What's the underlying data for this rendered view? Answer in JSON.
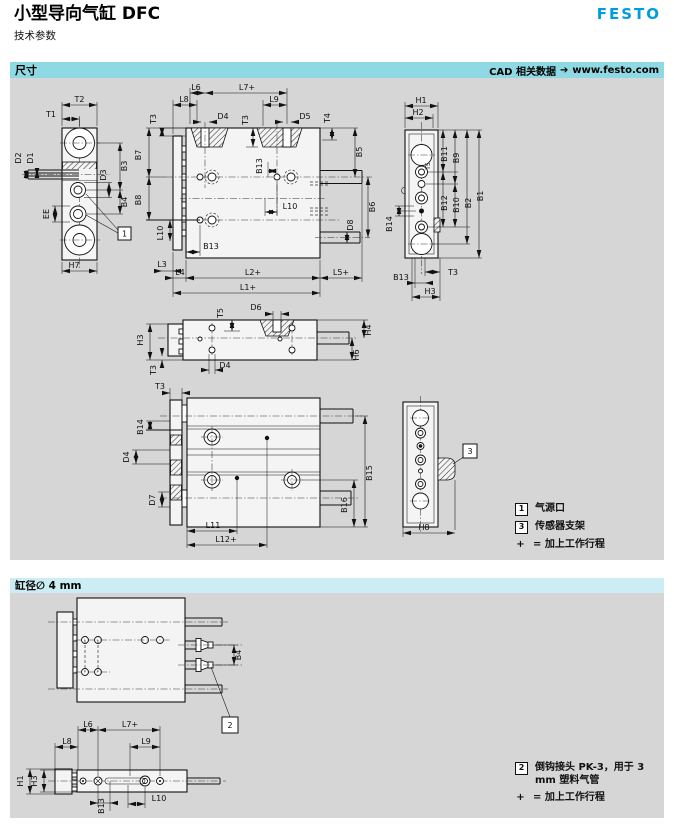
{
  "page": {
    "title": "小型导向气缸 DFC",
    "subtitle": "技术参数",
    "brand": "FESTO"
  },
  "sections": {
    "dimensions": {
      "label": "尺寸",
      "cad_text": "CAD 相关数据",
      "arrow": "➔",
      "cad_url": "www.festo.com"
    },
    "bore": {
      "label": "缸径∅ 4 mm"
    }
  },
  "legends": {
    "dimensions": {
      "items": [
        {
          "ref": "1",
          "text": "气源口"
        },
        {
          "ref": "3",
          "text": "传感器支架"
        }
      ],
      "plus": "+",
      "plus_text": "= 加上工作行程"
    },
    "bore": {
      "items": [
        {
          "ref": "2",
          "text": "倒钩接头 PK-3，用于 3 mm 塑料气管"
        }
      ],
      "plus": "+",
      "plus_text": "= 加上工作行程"
    }
  },
  "colors": {
    "festo_blue": "#009ddc",
    "section_bar": "#8fd9e4",
    "subsection_bar": "#cdedf4",
    "panel_bg": "#d6d6d6",
    "line": "#1a1a1a"
  },
  "views": {
    "end_view": {
      "callout": "1",
      "labels": {
        "t2": "T2",
        "t1": "T1",
        "d2": "D2",
        "d1": "D1",
        "d3": "D3",
        "b3": "B3",
        "b4": "B4",
        "ee": "EE",
        "h7": "H7"
      }
    },
    "top_view": {
      "labels": {
        "l6": "L6",
        "l7": "L7+",
        "l8": "L8",
        "l9": "L9",
        "d4": "D4",
        "d5": "D5",
        "t3_left": "T3",
        "t3_mid": "T3",
        "t4": "T4",
        "b5": "B5",
        "b6": "B6",
        "d8": "D8",
        "b13_mid": "B13",
        "l10_mid": "L10",
        "b7": "B7",
        "b8": "B8",
        "l10_left": "L10",
        "l3": "L3",
        "l4": "L4",
        "b13_bottom": "B13",
        "l2": "L2+",
        "l5": "L5+",
        "l1": "L1+"
      }
    },
    "side_view": {
      "labels": {
        "h1": "H1",
        "h2": "H2",
        "b11": "B11",
        "b9": "B9",
        "t5": "T5",
        "b12": "B12",
        "b10": "B10",
        "b2": "B2",
        "b1": "B1",
        "b14": "B14",
        "t3": "T3",
        "b13": "B13",
        "h3": "H3"
      }
    },
    "front_view": {
      "labels": {
        "t5": "T5",
        "d6": "D6",
        "h3": "H3",
        "t3": "T3",
        "d4": "D4",
        "h4": "H4",
        "h6": "H6"
      }
    },
    "guide_view": {
      "labels": {
        "t3": "T3",
        "b14": "B14",
        "d4": "D4",
        "d7": "D7",
        "l11": "L11",
        "l12": "L12+",
        "b15": "B15",
        "b16": "B16"
      }
    },
    "bracket_view": {
      "callout": "3",
      "labels": {
        "h8": "H8"
      }
    },
    "bore_top_view": {
      "callout": "2",
      "labels": {
        "b4": "B4"
      }
    },
    "bore_side_view": {
      "labels": {
        "l6": "L6",
        "l7": "L7+",
        "l8": "L8",
        "l9": "L9",
        "h1": "H1",
        "h3": "H3",
        "b13": "B13",
        "l10": "L10"
      }
    }
  }
}
